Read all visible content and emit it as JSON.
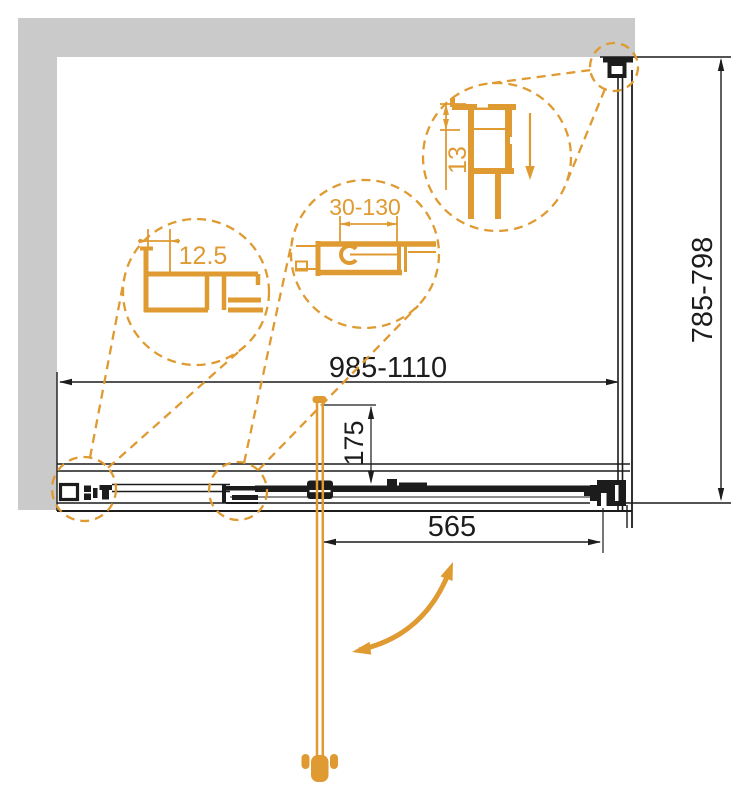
{
  "drawing": {
    "title": "shower-enclosure-installation-plan",
    "colors": {
      "accent_orange": "#df9a31",
      "wall_gray": "#cacaca",
      "line_black": "#1c1c1c"
    },
    "dims": {
      "door_width_range": "985-1110",
      "side_panel_range": "785-798",
      "opening": "565",
      "handle": "175"
    },
    "details": {
      "left": "12.5",
      "center": "30-130",
      "right": "13"
    }
  }
}
